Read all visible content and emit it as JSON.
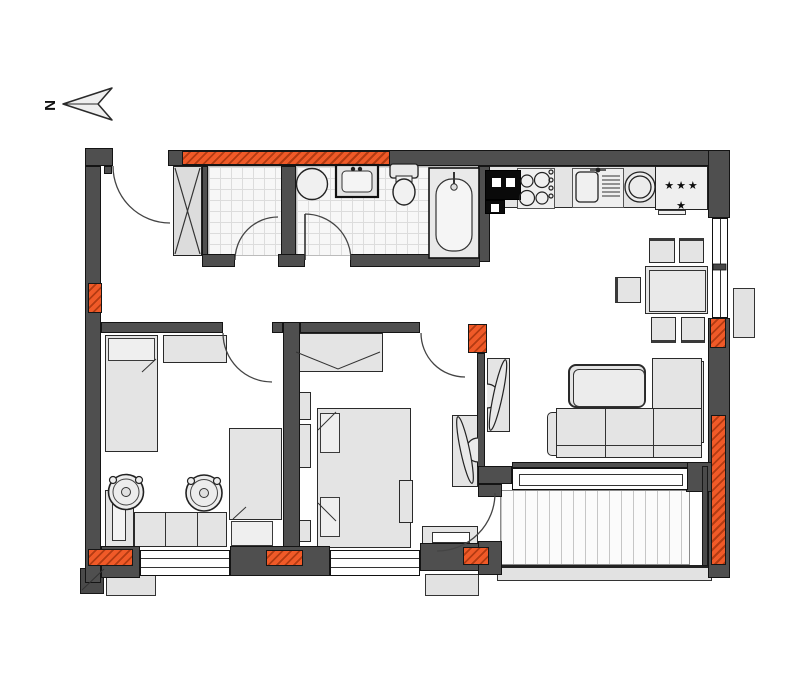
{
  "plan": {
    "north_label": "N",
    "fridge_stars": "★★★ ★",
    "colors": {
      "wall_gray": "#4f4f4f",
      "highlight_orange": "#f05a28",
      "furniture_fill": "#e4e4e4",
      "outline": "#141414",
      "tile_line": "#dcdcdc",
      "deck_line": "#c6c6c6"
    },
    "fixtures": [
      "north-arrow",
      "entrance-door",
      "ventilation-shaft",
      "wc-room",
      "bathroom",
      "washing-machine",
      "washbasin",
      "toilet",
      "bathtub",
      "kitchen-counter",
      "oven",
      "cooktop",
      "kitchen-sink",
      "round-basin",
      "fridge",
      "dining-table",
      "dining-chair",
      "corner-sofa",
      "coffee-table",
      "console-shelf",
      "double-bed",
      "nightstand",
      "wardrobe",
      "single-bed",
      "desk",
      "plant-pot",
      "plant",
      "terrace-deck",
      "window",
      "ac-unit"
    ]
  }
}
